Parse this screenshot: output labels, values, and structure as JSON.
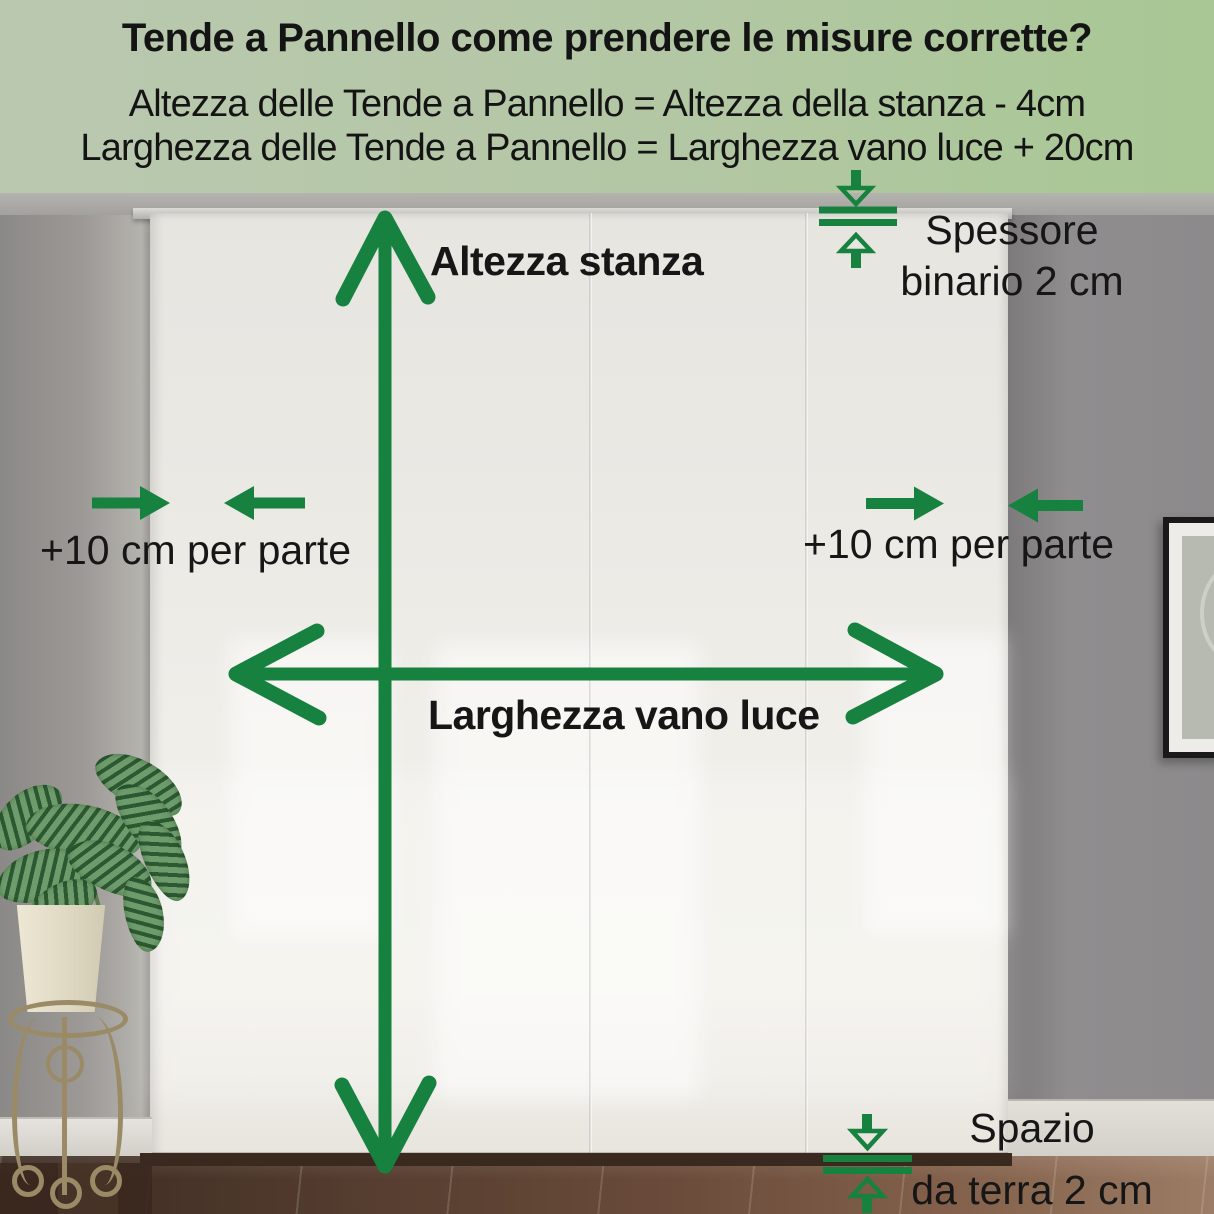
{
  "header": {
    "title": "Tende a Pannello come prendere le misure corrette?",
    "formula_height": "Altezza delle Tende a Pannello = Altezza della stanza - 4cm",
    "formula_width": "Larghezza delle Tende a Pannello = Larghezza vano luce + 20cm"
  },
  "labels": {
    "room_height": "Altezza stanza",
    "opening_width": "Larghezza vano luce",
    "side_margin_left": "+10 cm per parte",
    "side_margin_right": "+10 cm per parte",
    "rail_thickness_line1": "Spessore",
    "rail_thickness_line2": "binario 2 cm",
    "floor_gap_line1": "Spazio",
    "floor_gap_line2": "da terra 2 cm"
  },
  "colors": {
    "annotation_green": "#17813f",
    "header_bg_left": "#bac8b0",
    "header_bg_right": "#a8c794",
    "text": "#141414"
  }
}
